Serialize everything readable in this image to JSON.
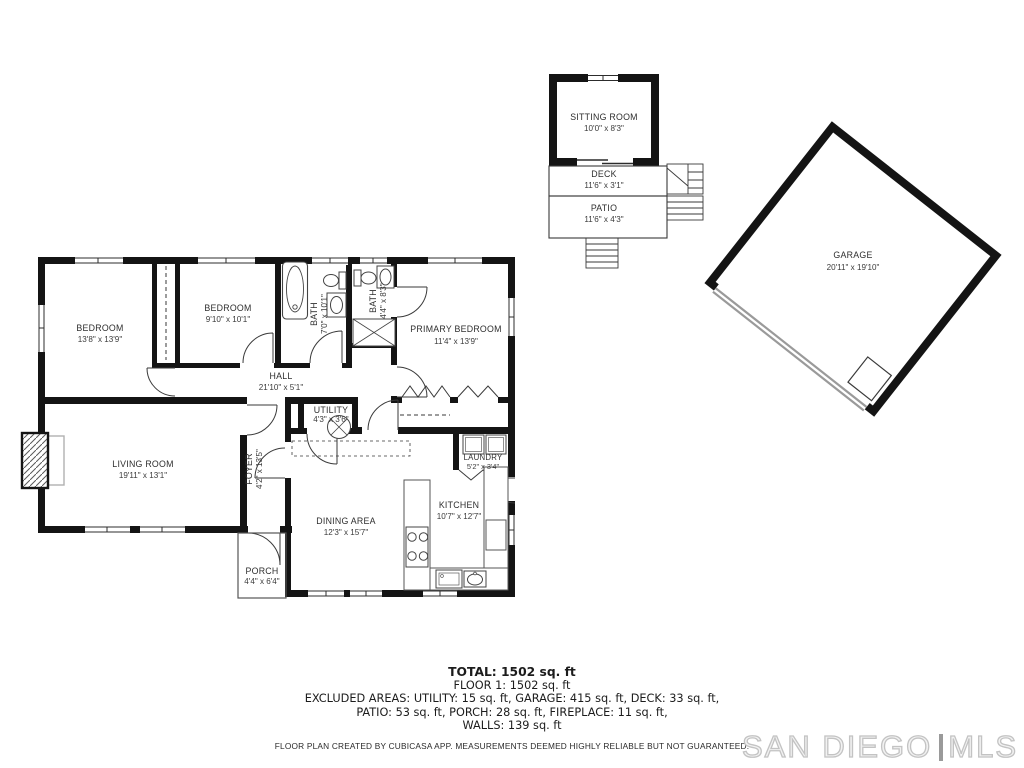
{
  "colors": {
    "wall": "#141414",
    "door_arc": "#3a3a3a",
    "counter_outline": "#555555",
    "hearth_outline": "#b0b0b0",
    "garage_door": "#9a9a9a",
    "watermark_gray": "#c3c3c3"
  },
  "rooms": {
    "bedroom1": {
      "label": "BEDROOM",
      "dims": "13'8\" x 13'9\""
    },
    "bedroom2": {
      "label": "BEDROOM",
      "dims": "9'10\" x 10'1\""
    },
    "bath1": {
      "label": "BATH",
      "dims": "7'0\" x 10'1\""
    },
    "bath2": {
      "label": "BATH",
      "dims": "4'4\" x 8'3\""
    },
    "primary": {
      "label": "PRIMARY BEDROOM",
      "dims": "11'4\" x 13'9\""
    },
    "hall": {
      "label": "HALL",
      "dims": "21'10\" x 5'1\""
    },
    "living": {
      "label": "LIVING ROOM",
      "dims": "19'11\" x 13'1\""
    },
    "foyer": {
      "label": "FOYER",
      "dims": "4'2\" x 13'5\""
    },
    "utility": {
      "label": "UTILITY",
      "dims": "4'3\" x 3'6\""
    },
    "dining": {
      "label": "DINING AREA",
      "dims": "12'3\" x 15'7\""
    },
    "kitchen": {
      "label": "KITCHEN",
      "dims": "10'7\" x 12'7\""
    },
    "laundry": {
      "label": "LAUNDRY",
      "dims": "5'2\" x 3'4\""
    },
    "porch": {
      "label": "PORCH",
      "dims": "4'4\" x 6'4\""
    },
    "sitting": {
      "label": "SITTING ROOM",
      "dims": "10'0\" x 8'3\""
    },
    "deck": {
      "label": "DECK",
      "dims": "11'6\" x 3'1\""
    },
    "patio": {
      "label": "PATIO",
      "dims": "11'6\" x 4'3\""
    },
    "garage": {
      "label": "GARAGE",
      "dims": "20'11\" x 19'10\""
    }
  },
  "summary": {
    "total": "TOTAL: 1502 sq. ft",
    "floor1": "FLOOR 1: 1502 sq. ft",
    "excluded_line1": "EXCLUDED AREAS: UTILITY: 15 sq. ft, GARAGE: 415 sq. ft, DECK: 33 sq. ft,",
    "excluded_line2": "PATIO: 53 sq. ft, PORCH: 28 sq. ft, FIREPLACE: 11 sq. ft,",
    "excluded_line3": "WALLS: 139 sq. ft",
    "disclaimer": "FLOOR PLAN CREATED BY CUBICASA APP. MEASUREMENTS DEEMED HIGHLY RELIABLE BUT NOT GUARANTEED."
  },
  "watermark": {
    "brand": "SAN DIEGO",
    "mls": "MLS"
  }
}
